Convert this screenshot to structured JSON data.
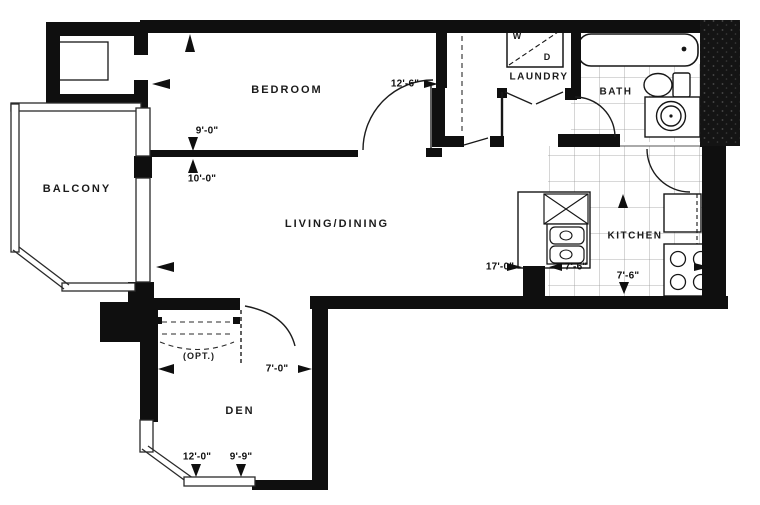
{
  "plan_title": "one-bedroom-plus-den-floor-plan",
  "rooms": {
    "balcony": "BALCONY",
    "bedroom": "BEDROOM",
    "laundry": "LAUNDRY",
    "washer": "W",
    "dryer": "D",
    "bath": "BATH",
    "kitchen": "KITCHEN",
    "living": "LIVING/DINING",
    "den": "DEN",
    "den_opt": "(OPT.)"
  },
  "dims": {
    "bedroom_w": "9'-0\"",
    "living_w": "10'-0\"",
    "bedroom_l": "12'-6\"",
    "living_l": "17'-0\"",
    "kitchen_counter": "7'-6\"",
    "kitchen_depth": "7'-6\"",
    "den_w": "7'-0\"",
    "den_l": "12'-0\"",
    "den_win": "9'-9\""
  },
  "colors": {
    "wall": "#0f0f0f",
    "line": "#1c1c1c",
    "tile_line": "#989898",
    "paper": "#ffffff"
  }
}
